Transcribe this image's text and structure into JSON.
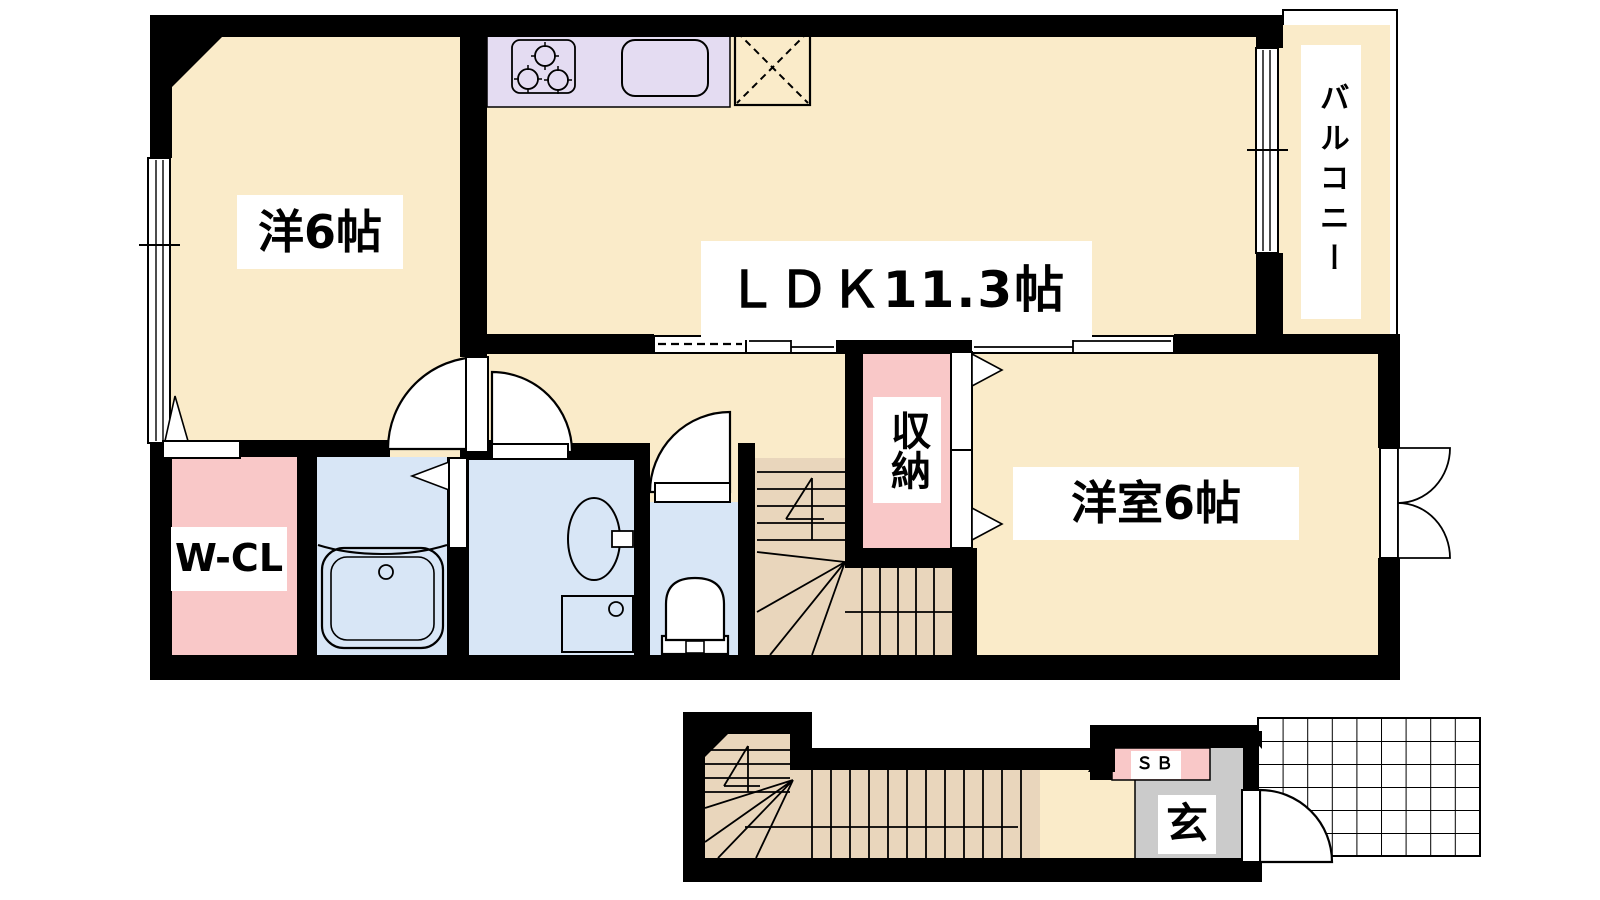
{
  "floor_plan": {
    "description": "Japanese maisonette apartment floor plan, upper living floor and lower entrance/stair block",
    "upper_floor": {
      "rooms": [
        {
          "id": "western_room_6",
          "label": "洋6帖"
        },
        {
          "id": "ldk",
          "label": "ＬＤＫ11.3帖"
        },
        {
          "id": "western_room_6b",
          "label": "洋室6帖"
        },
        {
          "id": "walk_in_closet",
          "label": "W-CL"
        },
        {
          "id": "storage",
          "label": "収納"
        },
        {
          "id": "balcony",
          "label": "バルコニー"
        }
      ],
      "fixtures": [
        "stove-3-burner",
        "kitchen-sink",
        "refrigerator-space",
        "bathtub",
        "washbasin",
        "washing-machine-pan",
        "toilet",
        "staircase"
      ]
    },
    "lower_floor": {
      "rooms": [
        {
          "id": "entrance",
          "label": "玄"
        },
        {
          "id": "shoe_box",
          "label": "ＳＢ"
        }
      ],
      "fixtures": [
        "staircase",
        "entrance-door",
        "porch-tile-grid"
      ]
    },
    "colors": {
      "cream": "#FAEBC9",
      "tan": "#E9D6BC",
      "pink": "#F9C8C8",
      "blue": "#D8E6F6",
      "lavender": "#E4DCF2",
      "gray": "#CBCBCB",
      "wall": "#000000",
      "white": "#FFFFFF"
    }
  }
}
